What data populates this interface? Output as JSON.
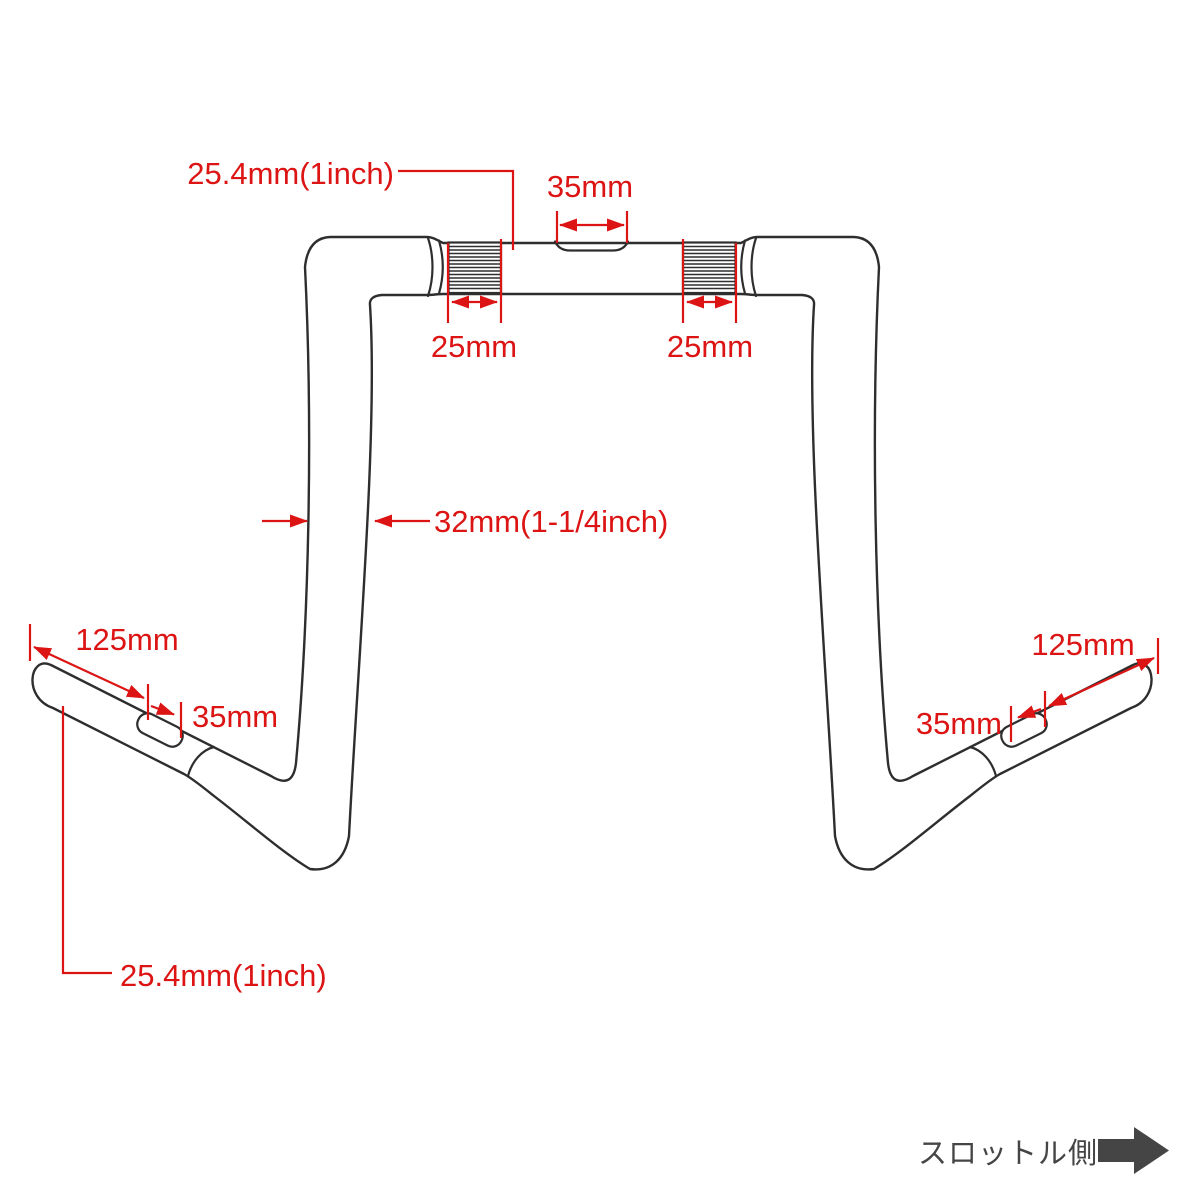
{
  "diagram": {
    "title_hint": "motorcycle ape-hanger handlebar dimension drawing",
    "colors": {
      "outline": "#2e2e2e",
      "dimension": "#dc1414",
      "throttle_text": "#454545",
      "background": "#ffffff"
    },
    "labels": {
      "clamp_area_diameter": "25.4mm(1inch)",
      "center_notch_width": "35mm",
      "knurl_width_left": "25mm",
      "knurl_width_right": "25mm",
      "riser_tube_diameter": "32mm(1-1/4inch)",
      "grip_length_left": "125mm",
      "grip_offset_left": "35mm",
      "grip_length_right": "125mm",
      "grip_offset_right": "35mm",
      "grip_end_diameter": "25.4mm(1inch)"
    },
    "throttle": {
      "label": "スロットル側"
    }
  }
}
